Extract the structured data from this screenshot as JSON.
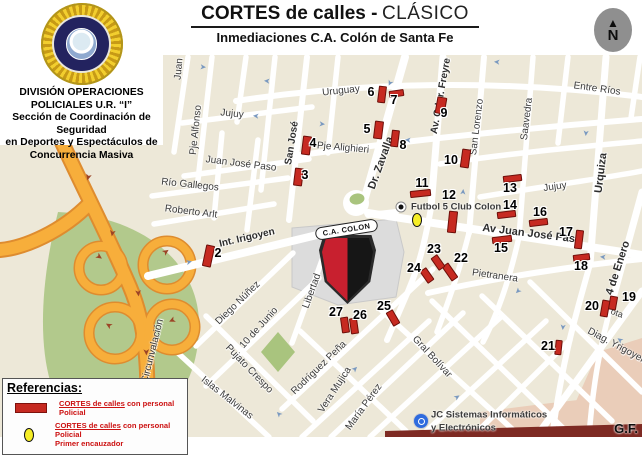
{
  "page": {
    "credit": "G.F."
  },
  "header": {
    "title_bold": "CORTES de calles -",
    "title_light": "CLÁSICO",
    "subtitle": "Inmediaciones C.A. Colón de Santa Fe"
  },
  "sidebar": {
    "badge_icon": "police-sunburst-badge",
    "lines": [
      "DIVISIÓN OPERACIONES",
      "POLICIALES U.R. “I”",
      "Sección de Coordinación de Seguridad",
      "en Deportes y Espectáculos de",
      "Concurrencia Masiva"
    ]
  },
  "compass": {
    "icon": "north-arrow",
    "label": "N"
  },
  "legend": {
    "title": "Referencias:",
    "items": [
      {
        "swatch": "red-bar",
        "label_underlined": "CORTES de calles",
        "label_rest": " con personal Policial",
        "label_line2": ""
      },
      {
        "swatch": "yellow-oval",
        "label_underlined": "CORTES de calles",
        "label_rest": " con personal Policial",
        "label_line2": "Primer encauzador"
      }
    ]
  },
  "map": {
    "colors": {
      "background": "#EDE8D8",
      "street": "#FFFFFF",
      "highway": "#F7AE3B",
      "highway_edge": "#DE8C2F",
      "park": "#B2C98C",
      "stadium_block": "#DCDCDC",
      "marker_red": "#C62A21",
      "encauzador_yellow": "#F6EE26",
      "pink_block": "#EACDB9",
      "one_way_arrow": "#7A99C0"
    },
    "stadium_crest": {
      "name": "C.A. COLON"
    },
    "pois": [
      {
        "icon": "dot-poi",
        "label": "Futbol 5 Club Colon",
        "x": 401,
        "y": 207
      },
      {
        "icon": "blue-circle-poi",
        "label": "JC Sistemas Informáticos",
        "label2": "y Electrónicos",
        "x": 421,
        "y": 421
      }
    ],
    "street_labels": [
      {
        "t": "Juan",
        "x": 179,
        "y": 69,
        "r": -85
      },
      {
        "t": "Pje Alfonso",
        "x": 196,
        "y": 130,
        "r": -84
      },
      {
        "t": "Jujuy",
        "x": 232,
        "y": 114,
        "r": 6
      },
      {
        "t": "San José",
        "x": 292,
        "y": 143,
        "r": -81,
        "b": 1
      },
      {
        "t": "Pje Alighieri",
        "x": 343,
        "y": 148,
        "r": 5
      },
      {
        "t": "Juan José Paso",
        "x": 241,
        "y": 164,
        "r": 7
      },
      {
        "t": "Río Gallegos",
        "x": 190,
        "y": 185,
        "r": 6
      },
      {
        "t": "Roberto Arlt",
        "x": 191,
        "y": 212,
        "r": 7
      },
      {
        "t": "Uruguay",
        "x": 341,
        "y": 91,
        "r": -6
      },
      {
        "t": "Dr. Zavalla",
        "x": 381,
        "y": 163,
        "r": -70,
        "b": 1,
        "fs": 11
      },
      {
        "t": "Av. Gdor. Freyre",
        "x": 441,
        "y": 96,
        "r": -80,
        "b": 1
      },
      {
        "t": "San Lorenzo",
        "x": 477,
        "y": 127,
        "r": -83
      },
      {
        "t": "Saavedra",
        "x": 527,
        "y": 119,
        "r": -83
      },
      {
        "t": "Entre Ríos",
        "x": 597,
        "y": 89,
        "r": 8
      },
      {
        "t": "Urquiza",
        "x": 601,
        "y": 173,
        "r": -83,
        "b": 1,
        "fs": 11
      },
      {
        "t": "Jujuy",
        "x": 555,
        "y": 187,
        "r": -8
      },
      {
        "t": "Av Juan José Paso",
        "x": 532,
        "y": 234,
        "r": 7,
        "b": 1,
        "fs": 11
      },
      {
        "t": "Pietranera",
        "x": 495,
        "y": 276,
        "r": 8
      },
      {
        "t": "4 de Enero",
        "x": 618,
        "y": 268,
        "r": -72,
        "b": 1,
        "fs": 11
      },
      {
        "t": "ota",
        "x": 617,
        "y": 313,
        "r": 20,
        "fs": 9
      },
      {
        "t": "Diag. Yrigoyen",
        "x": 617,
        "y": 346,
        "r": 28
      },
      {
        "t": "Int. Irigoyen",
        "x": 247,
        "y": 238,
        "r": -13,
        "b": 1
      },
      {
        "t": "Av Circunvalación",
        "x": 151,
        "y": 358,
        "r": -76
      },
      {
        "t": "Diego Núñez",
        "x": 238,
        "y": 303,
        "r": -44
      },
      {
        "t": "10 de Junio",
        "x": 259,
        "y": 328,
        "r": -48
      },
      {
        "t": "Pujato Crespo",
        "x": 249,
        "y": 369,
        "r": 46
      },
      {
        "t": "Islas Malvinas",
        "x": 227,
        "y": 398,
        "r": 38
      },
      {
        "t": "Libertad",
        "x": 312,
        "y": 291,
        "r": -70
      },
      {
        "t": "Rodríguez Peña",
        "x": 319,
        "y": 368,
        "r": -44
      },
      {
        "t": "Vera Mujica",
        "x": 335,
        "y": 390,
        "r": -57
      },
      {
        "t": "María Pérez",
        "x": 364,
        "y": 407,
        "r": -54
      },
      {
        "t": "Gral Bolívar",
        "x": 432,
        "y": 357,
        "r": 47
      }
    ],
    "markers": [
      {
        "n": "2",
        "bx": 204,
        "by": 245,
        "bw": 9,
        "bh": 22,
        "br": 12,
        "nx": 218,
        "ny": 253
      },
      {
        "n": "3",
        "bx": 294,
        "by": 168,
        "bw": 9,
        "bh": 18,
        "br": 7,
        "nx": 305,
        "ny": 175
      },
      {
        "n": "4",
        "bx": 302,
        "by": 136,
        "bw": 9,
        "bh": 19,
        "br": 7,
        "nx": 313,
        "ny": 143
      },
      {
        "n": "5",
        "bx": 374,
        "by": 121,
        "bw": 9,
        "bh": 18,
        "br": 7,
        "nx": 367,
        "ny": 129
      },
      {
        "n": "6",
        "bx": 378,
        "by": 86,
        "bw": 8,
        "bh": 17,
        "br": 7,
        "nx": 371,
        "ny": 92
      },
      {
        "n": "7",
        "bx": 389,
        "by": 90,
        "bw": 15,
        "bh": 7,
        "br": -8,
        "nx": 394,
        "ny": 100
      },
      {
        "n": "8",
        "bx": 391,
        "by": 130,
        "bw": 8,
        "bh": 17,
        "br": 7,
        "nx": 403,
        "ny": 145
      },
      {
        "n": "9",
        "bx": 436,
        "by": 97,
        "bw": 10,
        "bh": 17,
        "br": 10,
        "nx": 444,
        "ny": 113
      },
      {
        "n": "10",
        "bx": 461,
        "by": 149,
        "bw": 9,
        "bh": 19,
        "br": 8,
        "nx": 451,
        "ny": 160
      },
      {
        "n": "11",
        "bx": 410,
        "by": 190,
        "bw": 21,
        "bh": 7,
        "br": -6,
        "nx": 422,
        "ny": 183
      },
      {
        "n": "12",
        "bx": 448,
        "by": 211,
        "bw": 9,
        "bh": 22,
        "br": 6,
        "nx": 449,
        "ny": 195
      },
      {
        "n": "13",
        "bx": 503,
        "by": 175,
        "bw": 19,
        "bh": 7,
        "br": -7,
        "nx": 510,
        "ny": 188
      },
      {
        "n": "14",
        "bx": 497,
        "by": 211,
        "bw": 19,
        "bh": 7,
        "br": -7,
        "nx": 510,
        "ny": 205
      },
      {
        "n": "15",
        "bx": 492,
        "by": 236,
        "bw": 20,
        "bh": 7,
        "br": -7,
        "nx": 501,
        "ny": 248
      },
      {
        "n": "16",
        "bx": 529,
        "by": 219,
        "bw": 19,
        "bh": 7,
        "br": -7,
        "nx": 540,
        "ny": 212
      },
      {
        "n": "17",
        "bx": 575,
        "by": 230,
        "bw": 8,
        "bh": 19,
        "br": 7,
        "nx": 566,
        "ny": 232
      },
      {
        "n": "18",
        "bx": 573,
        "by": 254,
        "bw": 17,
        "bh": 7,
        "br": -7,
        "nx": 581,
        "ny": 266
      },
      {
        "n": "19",
        "bx": 609,
        "by": 296,
        "bw": 8,
        "bh": 14,
        "br": 10,
        "nx": 629,
        "ny": 297
      },
      {
        "n": "20",
        "bx": 601,
        "by": 300,
        "bw": 8,
        "bh": 17,
        "br": 10,
        "nx": 592,
        "ny": 306
      },
      {
        "n": "21",
        "bx": 555,
        "by": 340,
        "bw": 7,
        "bh": 15,
        "br": 6,
        "nx": 548,
        "ny": 346
      },
      {
        "n": "22",
        "bx": 446,
        "by": 263,
        "bw": 8,
        "bh": 18,
        "br": -35,
        "nx": 461,
        "ny": 258
      },
      {
        "n": "23",
        "bx": 434,
        "by": 255,
        "bw": 8,
        "bh": 15,
        "br": -35,
        "nx": 434,
        "ny": 249
      },
      {
        "n": "24",
        "bx": 423,
        "by": 268,
        "bw": 8,
        "bh": 15,
        "br": -35,
        "nx": 414,
        "ny": 268
      },
      {
        "n": "25",
        "bx": 389,
        "by": 310,
        "bw": 8,
        "bh": 16,
        "br": -30,
        "nx": 384,
        "ny": 306
      },
      {
        "n": "26",
        "bx": 350,
        "by": 318,
        "bw": 8,
        "bh": 16,
        "br": -8,
        "nx": 360,
        "ny": 315
      },
      {
        "n": "27",
        "bx": 341,
        "by": 317,
        "bw": 8,
        "bh": 16,
        "br": -8,
        "nx": 336,
        "ny": 312
      }
    ],
    "one_way_arrows": [
      {
        "x": 203,
        "y": 67,
        "r": 5
      },
      {
        "x": 267,
        "y": 81,
        "r": 185
      },
      {
        "x": 256,
        "y": 116,
        "r": 185
      },
      {
        "x": 322,
        "y": 124,
        "r": 5
      },
      {
        "x": 497,
        "y": 62,
        "r": 185
      },
      {
        "x": 408,
        "y": 140,
        "r": 185
      },
      {
        "x": 463,
        "y": 192,
        "r": -85
      },
      {
        "x": 586,
        "y": 133,
        "r": 95
      },
      {
        "x": 603,
        "y": 257,
        "r": 185
      },
      {
        "x": 563,
        "y": 327,
        "r": 95
      },
      {
        "x": 620,
        "y": 340,
        "r": 215
      },
      {
        "x": 279,
        "y": 414,
        "r": 225
      },
      {
        "x": 355,
        "y": 369,
        "r": -45
      },
      {
        "x": 457,
        "y": 397,
        "r": -35
      },
      {
        "x": 189,
        "y": 262,
        "r": -14
      },
      {
        "x": 518,
        "y": 291,
        "r": 135
      },
      {
        "x": 390,
        "y": 83,
        "r": 115
      }
    ],
    "highway_arrows": [
      {
        "x": 88,
        "y": 177,
        "r": 105
      },
      {
        "x": 112,
        "y": 233,
        "r": 100
      },
      {
        "x": 138,
        "y": 293,
        "r": 85
      },
      {
        "x": 146,
        "y": 352,
        "r": 88
      },
      {
        "x": 99,
        "y": 257,
        "r": 35
      },
      {
        "x": 166,
        "y": 252,
        "r": -35
      },
      {
        "x": 109,
        "y": 325,
        "r": 210
      },
      {
        "x": 172,
        "y": 320,
        "r": 155
      }
    ]
  }
}
